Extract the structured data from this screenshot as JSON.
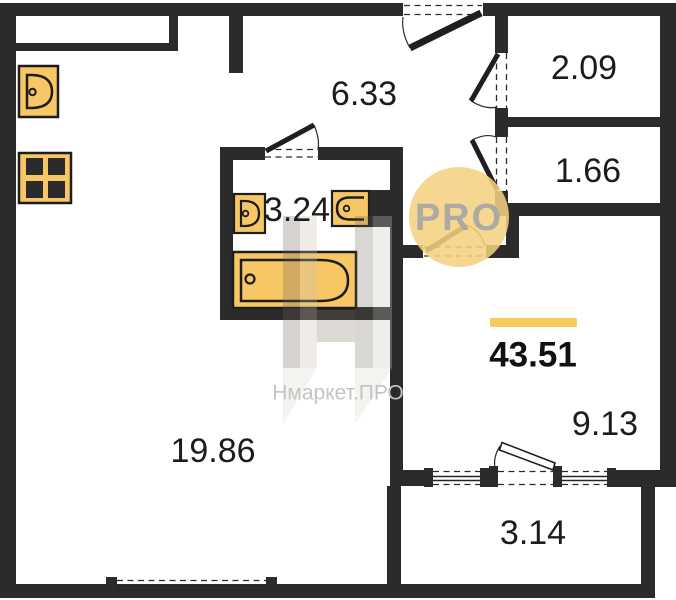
{
  "areas": {
    "living": "19.86",
    "hallway": "6.33",
    "storage_upper": "2.09",
    "storage_lower": "1.66",
    "bathroom": "3.24",
    "room": "9.13",
    "balcony": "3.14",
    "total": "43.51"
  },
  "watermark": {
    "logo_badge": "PRO",
    "brand": "Нмаркет.ПРО"
  },
  "colors": {
    "wall": "#2b2b2b",
    "fixture-fill": "#f7c766",
    "fixture-stroke": "#1d1d1d",
    "accent-bar": "#f8cb5e",
    "logo-circle": "#f3d181",
    "logo-text": "#a6a6a6",
    "watermark-text": "#c4c4c4",
    "label": "#1c1c1c"
  }
}
